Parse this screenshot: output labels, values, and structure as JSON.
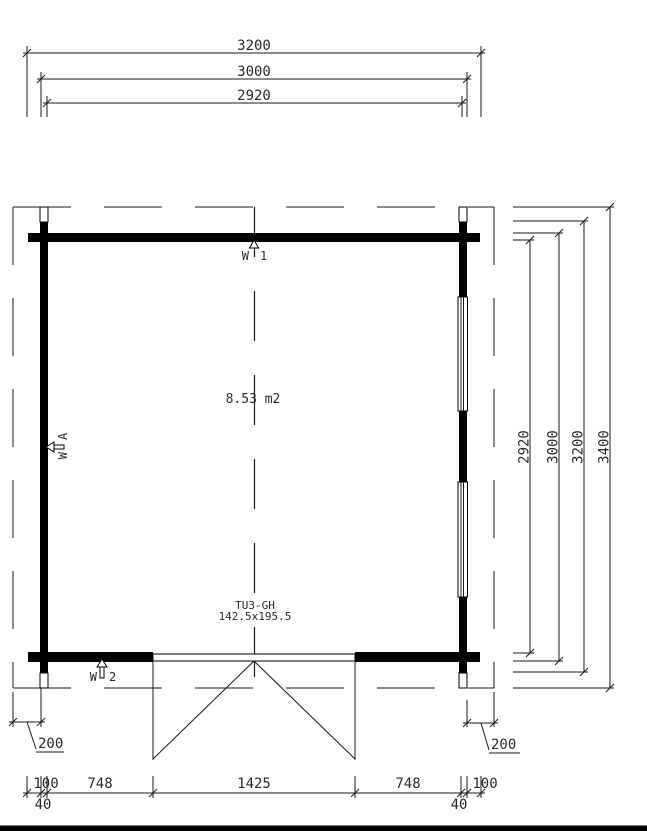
{
  "dims": {
    "top": [
      "3200",
      "3000",
      "2920"
    ],
    "right": [
      "2920",
      "3000",
      "3200",
      "3400"
    ],
    "bottom": [
      "100",
      "40",
      "748",
      "1425",
      "748",
      "40",
      "100"
    ],
    "overhang_left": "200",
    "overhang_right": "200"
  },
  "labels": {
    "area": "8.53 m2",
    "door_code": "TU3-GH",
    "door_size": "142.5x195.5",
    "wall_top_prefix": "W",
    "wall_top_id": "1",
    "wall_bottom_prefix": "W",
    "wall_bottom_id": "2",
    "wall_left_prefix": "W",
    "wall_left_id": "A"
  },
  "colors": {
    "line": "#1a1a1a",
    "wall": "#000000",
    "text": "#2a2a2a",
    "background": "#ffffff"
  }
}
